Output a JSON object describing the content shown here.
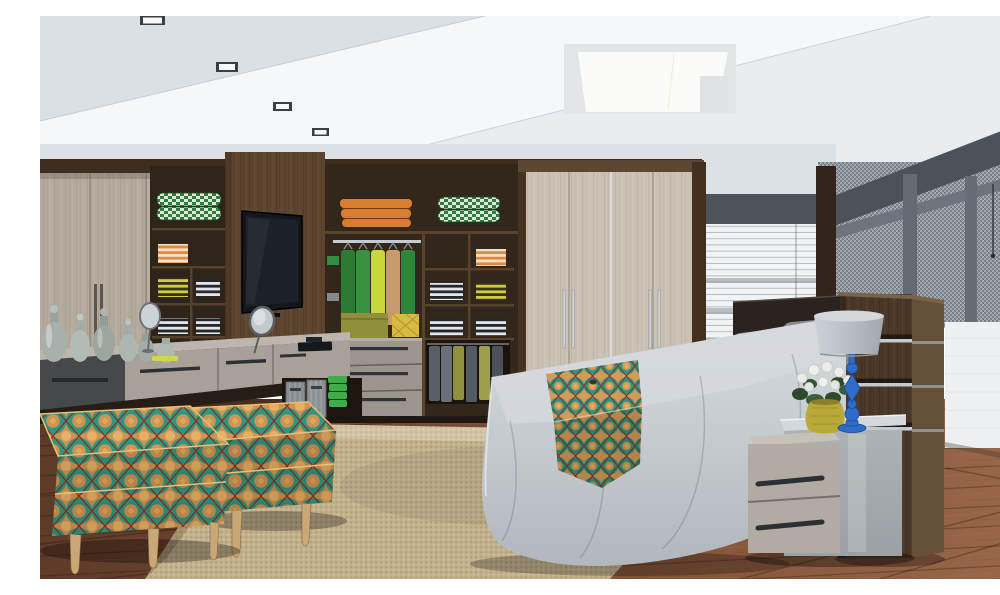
{
  "scene": {
    "description": "Photorealistic 3D rendering of a bedroom with a fitted closet wall: open shelving with folded colorful clothes and hanging green shirts, a wall-mounted TV on a wood panel, a floating vanity console with glass bottles and round mirrors, two teal-and-orange patterned ottomans, a sisal rug on dark hardwood, a bed with gray bedspread, yellow accent pillows and a patterned throw, a dark wood headboard partition with chrome inlays, a nightstand with a blue table lamp and a vase of white roses, a window with venetian blinds and a woven-metal screen partition",
    "objects": [
      "recessed ceiling downlights",
      "square ceiling light panel",
      "left wardrobe doors",
      "shelving with folded clothes",
      "tv wood panel",
      "flat screen tv",
      "center shelving unit",
      "hanging shirts",
      "storage boxes",
      "drawer cabinet",
      "hanging trousers",
      "center wardrobe doors",
      "window venetian blinds",
      "woven metal screen partition",
      "white partition wall",
      "headboard partition panel",
      "bed",
      "gray pillows",
      "yellow pillows",
      "patterned throw",
      "nightstand",
      "blue table lamp",
      "vase with white roses",
      "sisal rug",
      "hardwood floor",
      "vanity console",
      "glass bottles",
      "round vanity mirrors",
      "patterned ottomans",
      "metal baskets",
      "green towels"
    ]
  },
  "palette": {
    "ceiling_base": "#e9edf0",
    "ceiling_bright": "#f5f7f8",
    "ceiling_shade": "#dbe0e5",
    "wall": "#dce1e6",
    "wood_dark": "#3e2d1f",
    "wood_mid": "#4a3727",
    "wood_panel": "#5d4530",
    "door_greige": "#b3a99c",
    "door_cream": "#c9c1b4",
    "floor_wood": "#7c4e35",
    "rug": "#c2b08c",
    "bedspread": "#c6cbd0",
    "headboard": "#2b2320",
    "pillow_yellow": "#cbb228",
    "pillow_gray": "#9e979b",
    "throw_teal": "#2c9882",
    "throw_orange": "#cf9352",
    "lamp_blue": "#2f6cc9",
    "lamp_shade": "#d4d8dc",
    "mesh": "#8d949b",
    "mesh_frame": "#4c5258",
    "blind": "#f1f3f5",
    "partition_white": "#eef0f2",
    "nightstand_wood": "#b1aba1",
    "nightstand_gray": "#a6acb0",
    "green_towel": "#3fae4a",
    "orange_towel": "#d97e2e",
    "shirt_green": "#2f8f3f",
    "vase_yellow": "#b9a93a",
    "leg_wood": "#c9a877"
  }
}
